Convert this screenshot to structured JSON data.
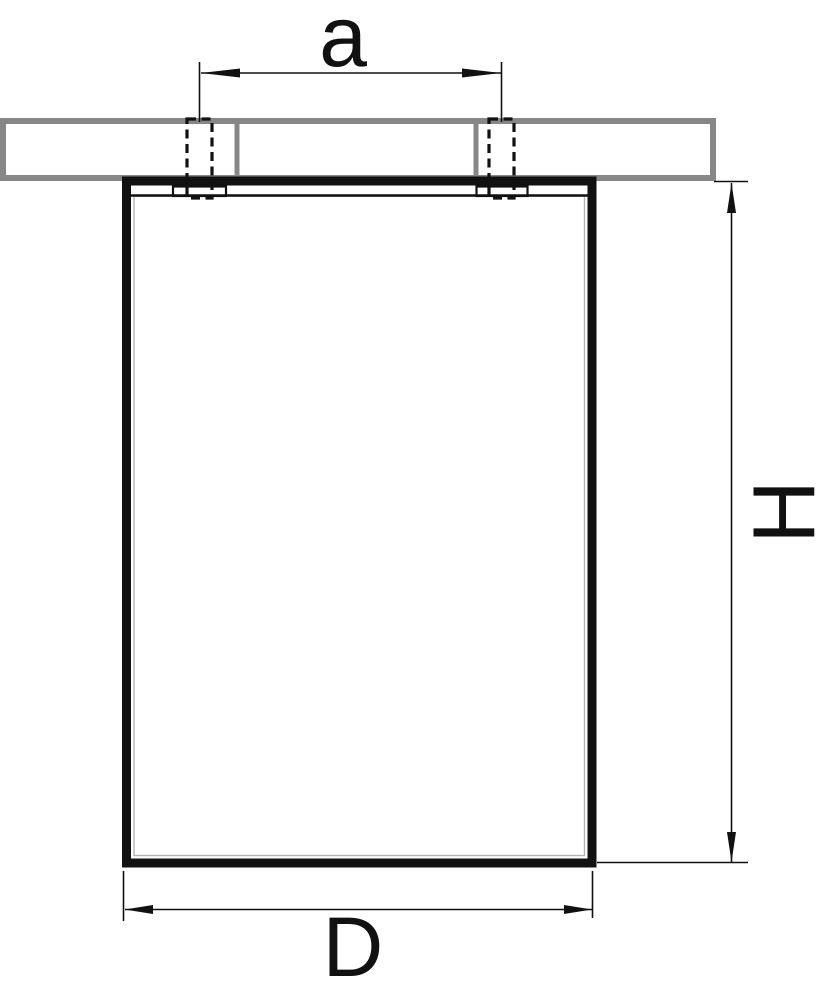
{
  "drawing": {
    "kind": "surface-mounted ceiling light fixture — dimensional side view",
    "labels": {
      "mounting_spacing": "a",
      "height": "H",
      "diameter": "D"
    },
    "features": {
      "ceiling": "hatched ceiling slab section",
      "screws": "two dashed mounting screw holes",
      "body": "rectangular fixture body"
    }
  },
  "colors": {
    "line": "#111111",
    "hatch": "#878787",
    "faint": "#b3b3b3",
    "background": "#ffffff"
  }
}
